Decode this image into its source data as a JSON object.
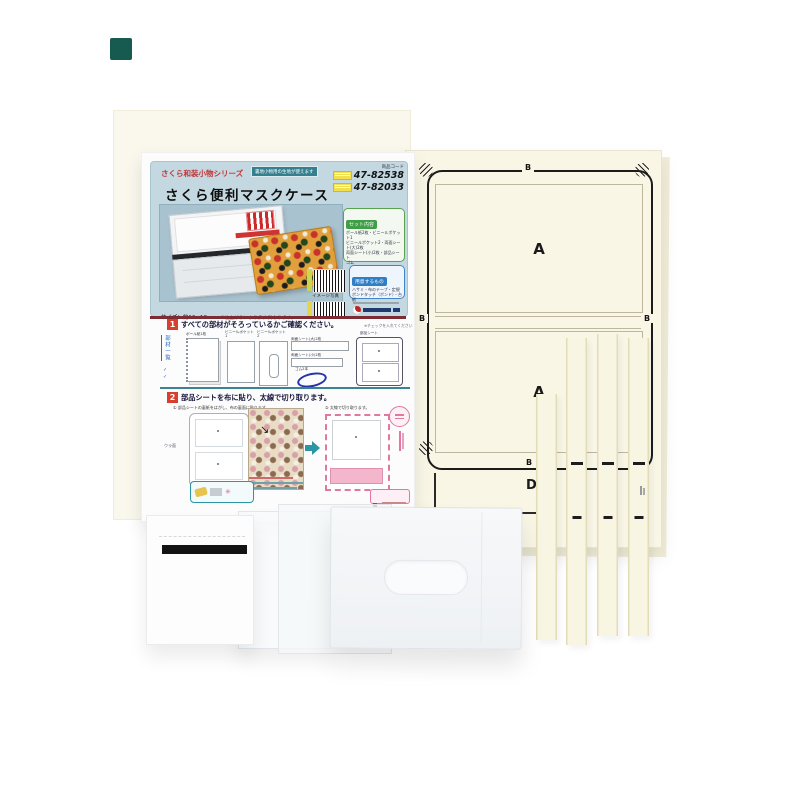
{
  "scene": {
    "type": "craft-kit-product-photo"
  },
  "instruction_sheet": {
    "header": {
      "series_label": "さくら和装小物シリーズ",
      "usage_badge": "裏地小物用の生地が使えます",
      "code_heading": "商品コード",
      "codes": [
        "47-82538",
        "47-82033"
      ],
      "title": "さくら便利マスクケース",
      "photo_caption": "イメージ写真",
      "size_note": "サイズ：約12×18cm",
      "size_note_red": "※仕上がりにより多少異なります。",
      "set_box_title": "セット内容",
      "set_box_lines": [
        "ボール紙2枚・ビニールポケット1",
        "ビニールポケット2・両面シート(大)2枚",
        "両面シート(小)2枚・部品シート",
        "ゴム"
      ],
      "prepare_box_title": "用意するもの",
      "prepare_box_lines": [
        "ハサミ・布のテープ・定規",
        "ボンドタッチ（ボンド）・台紙"
      ]
    },
    "step1": {
      "number": "1",
      "heading": "すべての部材がそろっているかご確認ください。",
      "side_note": "※チェックを入れてください",
      "list_label": "部材一覧",
      "items": {
        "board": "ボール紙1枚",
        "pocket1": "ビニールポケット1",
        "pocket2": "ビニールポケット2",
        "sheet_large": "両面シート(大)2枚",
        "sheet_small": "両面シート(小)2枚",
        "elastic": "ゴム2本",
        "parts_sheet": "部品シート"
      }
    },
    "step2": {
      "number": "2",
      "heading": "部品シートを布に貼り、太線で切り取ります。",
      "sub1": "① 部品シートの裏紙をはがし、布の裏面に貼ります。",
      "sub2": "② 太線で切り取ります。",
      "back_label": "ウラ面"
    }
  },
  "pattern_sheet": {
    "labels": {
      "b_top": "B",
      "a_top": "A",
      "b_left": "B",
      "b_right": "B",
      "a_mid": "A",
      "b_bottom": "B",
      "d": "D"
    }
  },
  "colors": {
    "header_card": "#c4d8e1",
    "accent_red": "#c43030",
    "teal_badge": "#35808f",
    "green_box": "#3f9e46",
    "blue_box": "#2f7fc6",
    "pattern_cream": "#f9f6e6",
    "maroon_rule": "#7e2c34"
  }
}
